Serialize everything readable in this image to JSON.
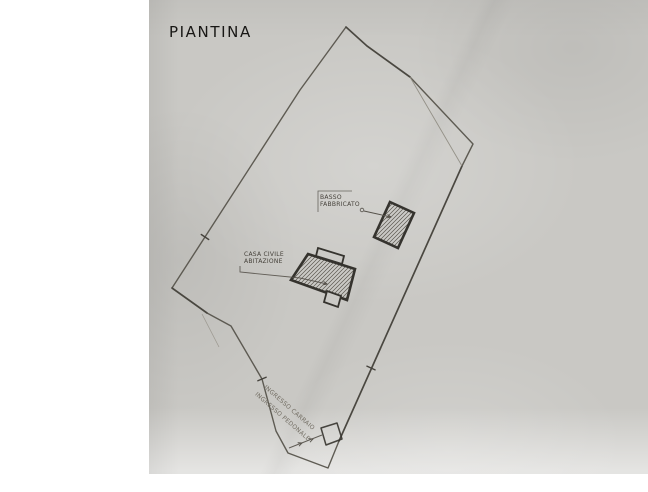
{
  "labels": {
    "title": "PIANTINA",
    "basso": {
      "line1": "BASSO",
      "line2": "FABBRICATO"
    },
    "casa": {
      "line1": "CASA CIVILE",
      "line2": "ABITAZIONE"
    },
    "entrance": {
      "line1": "INGRESSO CARRAIO",
      "line2": "INGRESSO PEDONALE"
    }
  },
  "colors": {
    "paper": "#c9c8c4",
    "page_background": "#ffffff",
    "boundary_stroke": "#57544c",
    "boundary_overdraw": "#45423c",
    "building_stroke": "#35332e",
    "hatch_stroke": "#5a564e",
    "leader_stroke": "#55514a",
    "faint_stroke": "#8d897f",
    "annex_fill": "#cbcac6"
  },
  "drawing": {
    "boundary": [
      [
        346,
        27
      ],
      [
        367,
        46
      ],
      [
        410,
        77
      ],
      [
        473,
        144
      ],
      [
        462,
        166
      ],
      [
        339,
        441
      ],
      [
        328,
        468
      ],
      [
        288,
        453
      ],
      [
        276,
        431
      ],
      [
        262,
        379
      ],
      [
        231,
        326
      ],
      [
        207,
        313
      ],
      [
        172,
        288
      ],
      [
        300,
        90
      ]
    ],
    "overdraw_segments": [
      [
        [
          346,
          27
        ],
        [
          367,
          46
        ],
        [
          410,
          77
        ]
      ],
      [
        [
          172,
          288
        ],
        [
          207,
          313
        ]
      ],
      [
        [
          462,
          166
        ],
        [
          339,
          441
        ]
      ]
    ],
    "sliver_line": [
      [
        410,
        77
      ],
      [
        462,
        166
      ]
    ],
    "stray_line": [
      [
        202,
        314
      ],
      [
        219,
        347
      ]
    ],
    "ticks": [
      [
        205,
        237,
        34
      ],
      [
        262,
        379,
        -23
      ],
      [
        371,
        368,
        24
      ]
    ],
    "entrance_line": [
      [
        289,
        448
      ],
      [
        322,
        435
      ]
    ],
    "entrance_arrow_marks": [
      [
        302,
        443
      ],
      [
        313,
        439
      ]
    ],
    "gate_box": [
      [
        321,
        428
      ],
      [
        337,
        423
      ],
      [
        342,
        439
      ],
      [
        326,
        445
      ]
    ],
    "buildings": {
      "basso_fabbricato": [
        [
          390,
          202
        ],
        [
          414,
          213
        ],
        [
          398,
          248
        ],
        [
          374,
          237
        ]
      ],
      "casa_main": [
        [
          308,
          254
        ],
        [
          355,
          269
        ],
        [
          347,
          300
        ],
        [
          291,
          280
        ]
      ],
      "casa_top_annex": [
        [
          318,
          248
        ],
        [
          344,
          256
        ],
        [
          342,
          264
        ],
        [
          316,
          256
        ]
      ],
      "casa_bottom_annex": [
        [
          327,
          291
        ],
        [
          341,
          296
        ],
        [
          338,
          307
        ],
        [
          324,
          302
        ]
      ]
    },
    "leaders": {
      "basso_bracket": [
        [
          318,
          212
        ],
        [
          318,
          191
        ],
        [
          352,
          191
        ]
      ],
      "basso_arrow_circle": [
        362,
        210
      ],
      "basso_arrow_line": [
        [
          364,
          211
        ],
        [
          391,
          217
        ]
      ],
      "casa_leader": [
        [
          240,
          266
        ],
        [
          240,
          272
        ],
        [
          300,
          278
        ],
        [
          327,
          284
        ]
      ]
    }
  }
}
